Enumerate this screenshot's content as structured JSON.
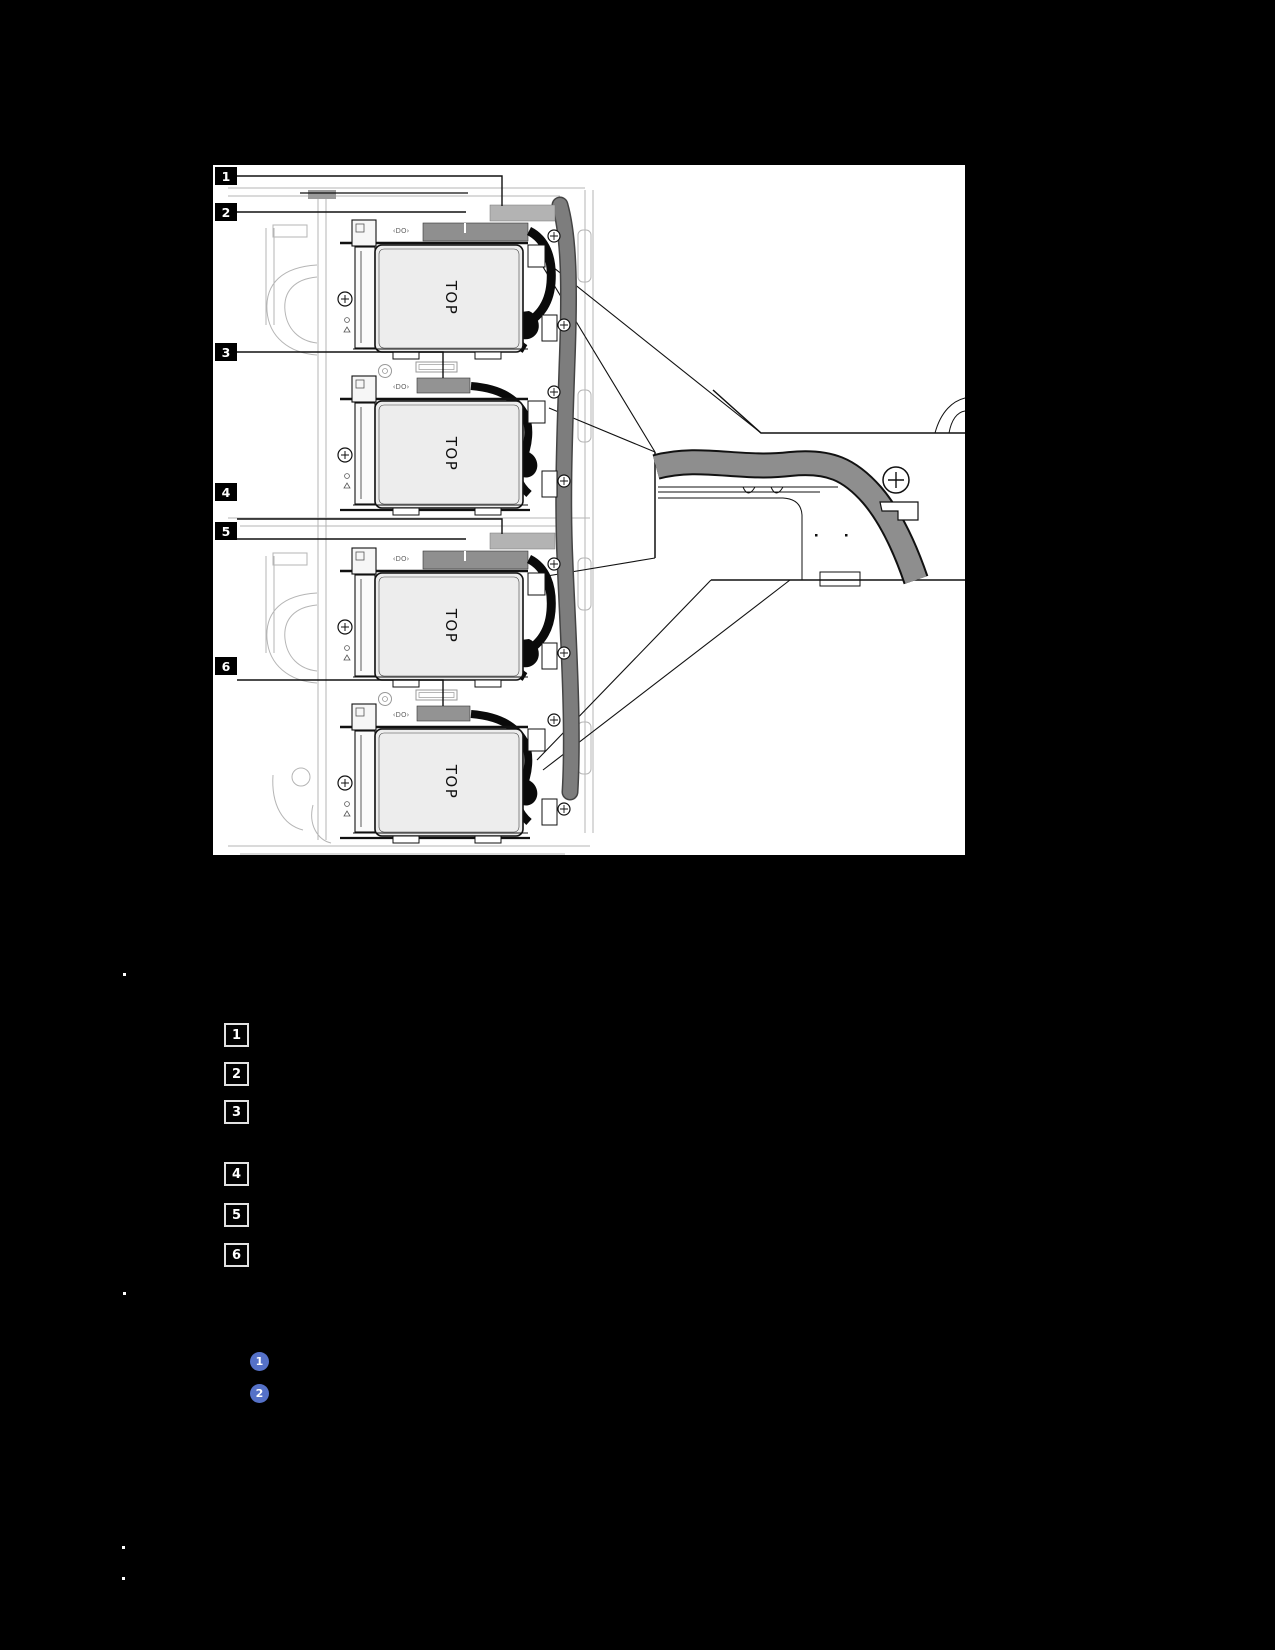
{
  "figure": {
    "drive_top_label": "TOP",
    "tray_label": "‹DO›",
    "callouts": [
      {
        "label": "1"
      },
      {
        "label": "2"
      },
      {
        "label": "3"
      },
      {
        "label": "4"
      },
      {
        "label": "5"
      },
      {
        "label": "6"
      }
    ],
    "colors": {
      "figure_bg": "#ffffff",
      "page_bg": "#000000",
      "chassis_gray": "#b5b5b5",
      "connector_dark": "#8f8f8f",
      "connector_light": "#b3b3b3",
      "cable_gray": "#8e8e8e",
      "long_cable_gray": "#7d7d7d",
      "line_black": "#111111"
    }
  },
  "legend": {
    "items": [
      {
        "label": "1"
      },
      {
        "label": "2"
      },
      {
        "label": "3"
      },
      {
        "label": "4"
      },
      {
        "label": "5"
      },
      {
        "label": "6"
      }
    ]
  },
  "steps": {
    "badge_color": "#5571c8",
    "badges": [
      {
        "label": "1"
      },
      {
        "label": "2"
      }
    ]
  }
}
